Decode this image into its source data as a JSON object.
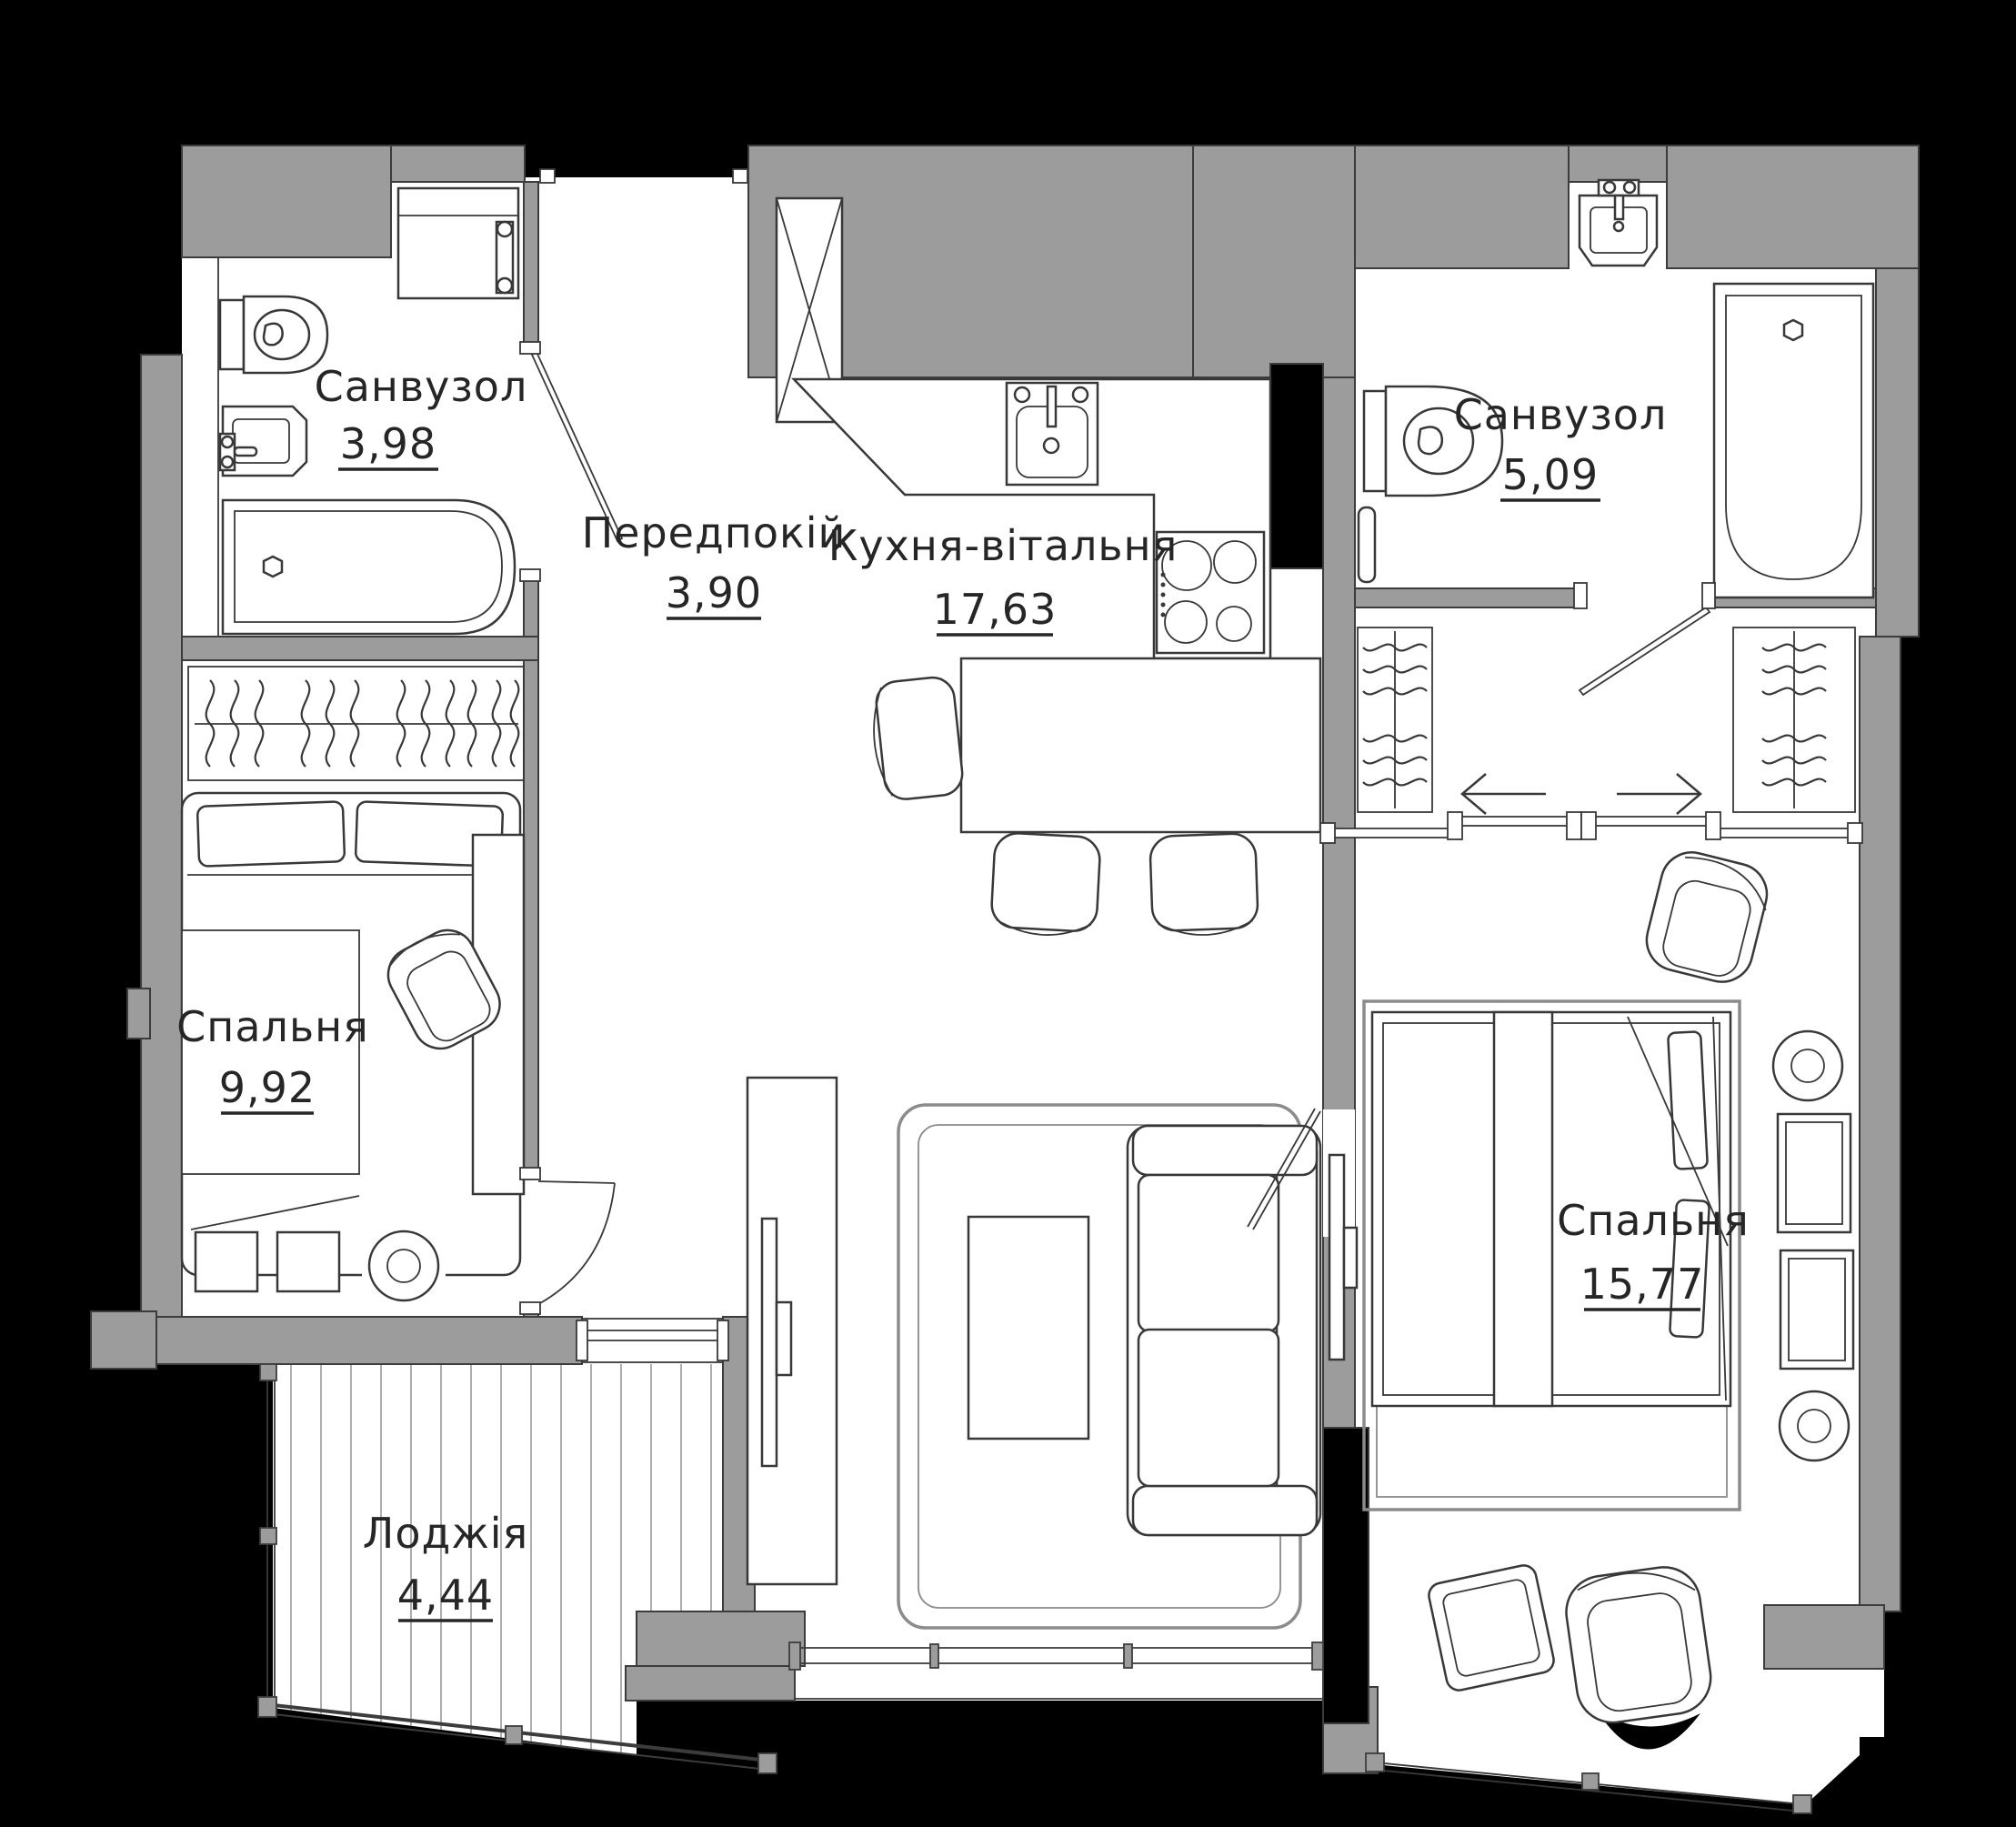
{
  "plan": {
    "type": "apartment-floor-plan",
    "language": "uk",
    "rooms": [
      {
        "id": "bathroom-1",
        "label": "Санвузол",
        "area": "3,98"
      },
      {
        "id": "hallway",
        "label": "Передпокій",
        "area": "3,90"
      },
      {
        "id": "kitchen-living",
        "label": "Кухня-вітальня",
        "area": "17,63"
      },
      {
        "id": "bathroom-2",
        "label": "Санвузол",
        "area": "5,09"
      },
      {
        "id": "bedroom-1",
        "label": "Спальня",
        "area": "9,92"
      },
      {
        "id": "bedroom-2",
        "label": "Спальня",
        "area": "15,77"
      },
      {
        "id": "loggia",
        "label": "Лоджія",
        "area": "4,44"
      }
    ],
    "colors": {
      "background": "#000000",
      "wall": "#9C9C9C",
      "floor": "#ffffff",
      "line": "#383838",
      "text": "#262626"
    }
  }
}
